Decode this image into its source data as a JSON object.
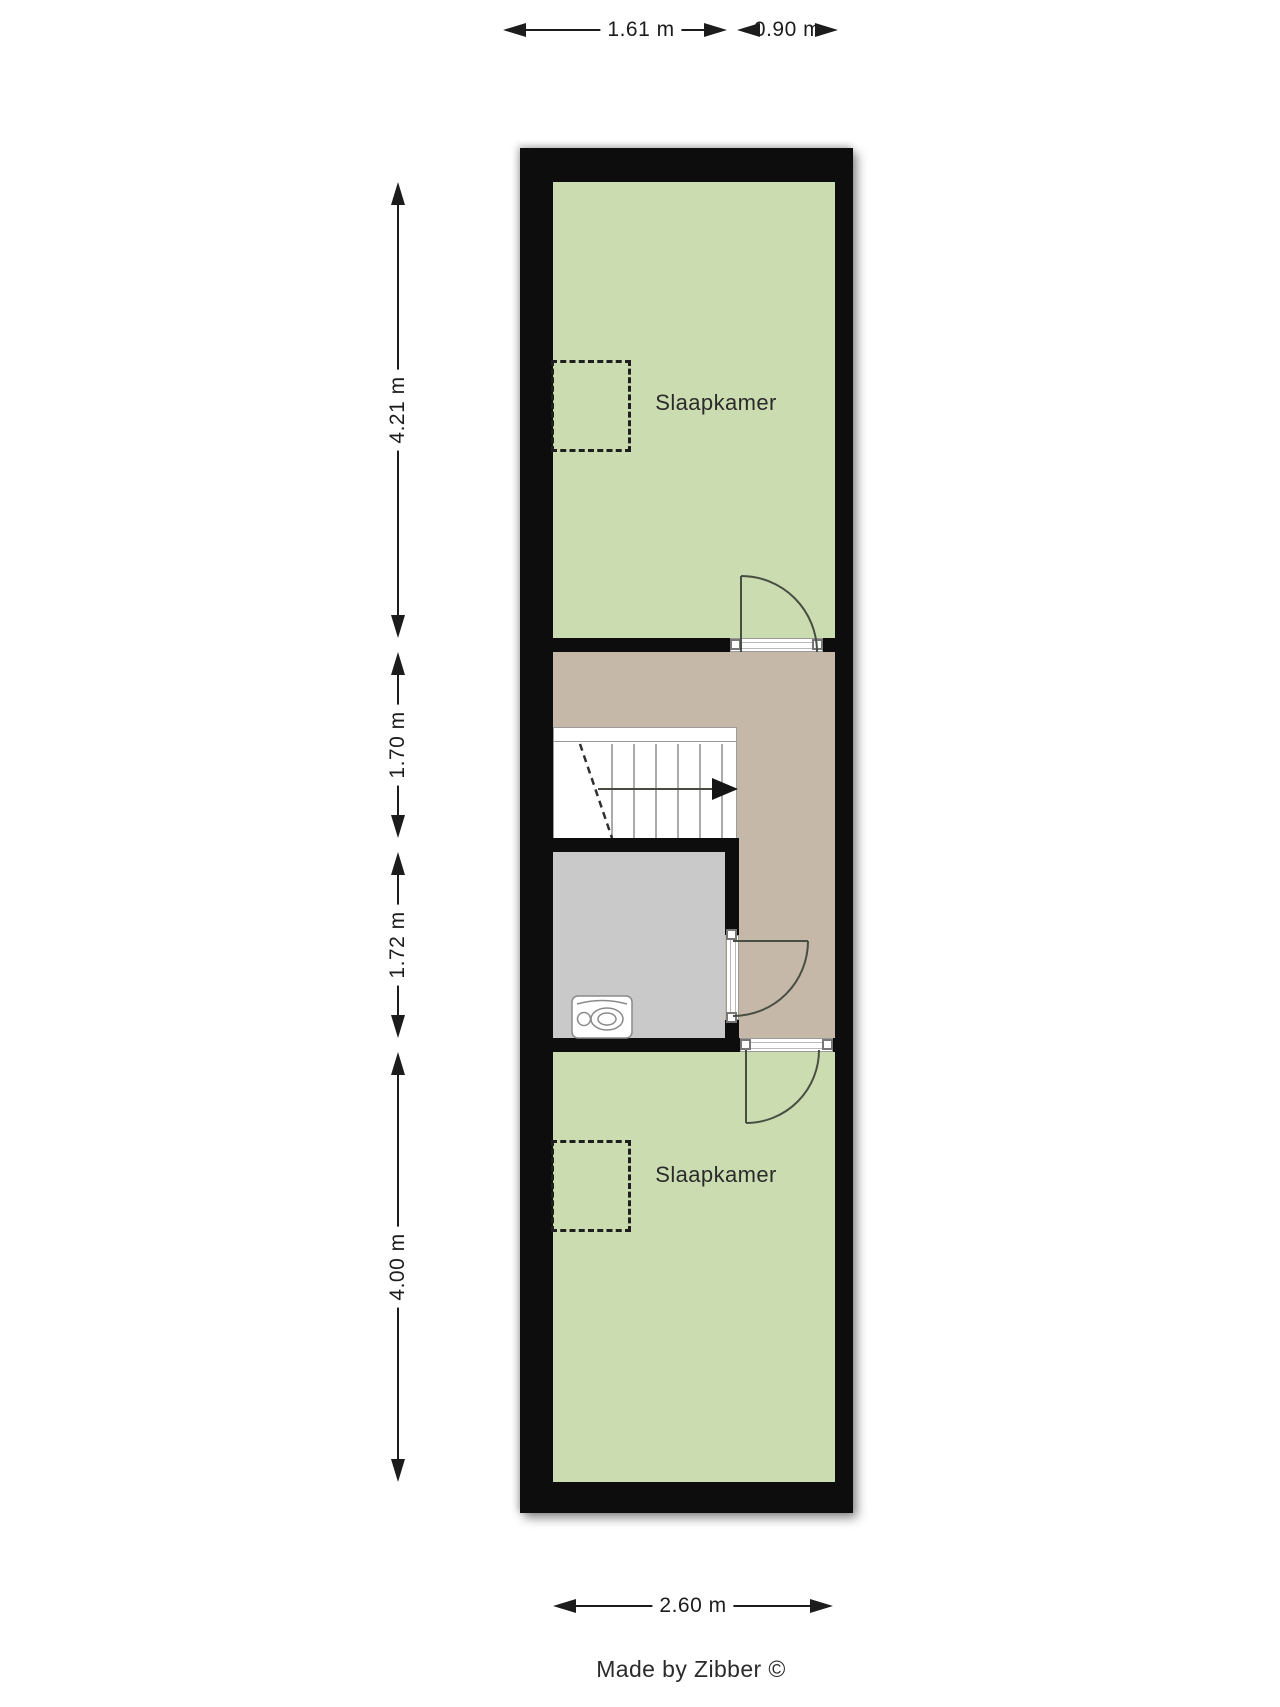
{
  "plan": {
    "rooms": {
      "bedroom_top": {
        "label": "Slaapkamer"
      },
      "bedroom_bottom": {
        "label": "Slaapkamer"
      }
    },
    "credit": "Made by Zibber ©"
  },
  "dimensions": {
    "top": [
      {
        "label": "1.61 m"
      },
      {
        "label": "0.90 m"
      }
    ],
    "left": [
      {
        "label": "4.21 m"
      },
      {
        "label": "1.70 m"
      },
      {
        "label": "1.72 m"
      },
      {
        "label": "4.00 m"
      }
    ],
    "bottom": [
      {
        "label": "2.60 m"
      }
    ]
  },
  "icons": {
    "stairs_direction": "right-arrow-triangle",
    "toilet": "toilet-top-view",
    "dimension_arrows": "solid-triangle-arrowheads"
  },
  "colors": {
    "wall": "#0d0d0d",
    "bedroom": "#cbdcb1",
    "hall": "#c6b8a9",
    "toilet": "#c9c9c9",
    "door": "#474f43",
    "stair": "#8f8f8f",
    "dash": "#1f1f1f",
    "dim": "#1c1c1c",
    "text": "#2b2b2b"
  }
}
